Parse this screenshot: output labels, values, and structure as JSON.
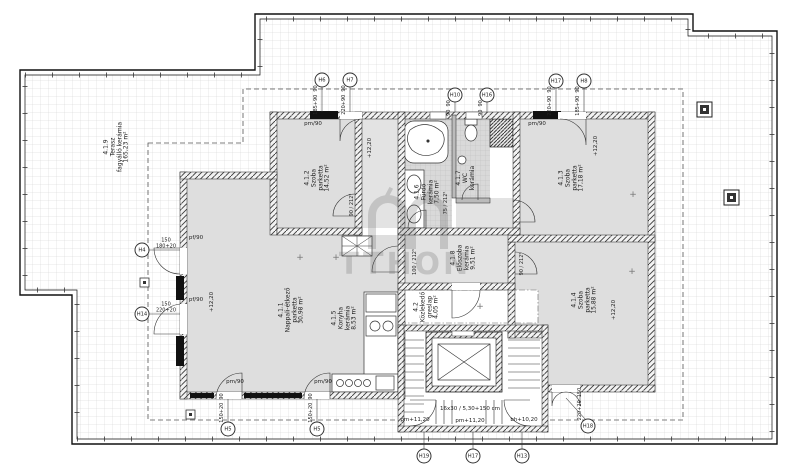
{
  "watermark": {
    "text": "TTHON"
  },
  "rooms": [
    {
      "id": "4.1.1",
      "name": "Nappali-étkező",
      "material": "parketta",
      "area": "30,98 m²"
    },
    {
      "id": "4.1.2",
      "name": "Szoba",
      "material": "parketta",
      "area": "14,52 m²"
    },
    {
      "id": "4.1.3",
      "name": "Szoba",
      "material": "parketta",
      "area": "17,18 m²"
    },
    {
      "id": "4.1.4",
      "name": "Szoba",
      "material": "parketta",
      "area": "15,88 m²"
    },
    {
      "id": "4.1.5",
      "name": "Konyha",
      "material": "kerámia",
      "area": "8,53 m²"
    },
    {
      "id": "4.1.6",
      "name": "Fürdő",
      "material": "kerámia",
      "area": "7,50 m²"
    },
    {
      "id": "4.1.7",
      "name": "WC",
      "material": "kerámia",
      "area": ""
    },
    {
      "id": "4.1.8",
      "name": "Előszoba",
      "material": "kerámia",
      "area": "9,51 m²"
    },
    {
      "id": "4.1.9",
      "name": "Terasz",
      "material": "fagyálló kerámia",
      "area": "165,23 m²"
    },
    {
      "id": "4.2",
      "name": "Közlekedő",
      "material": "greslap",
      "area": "4,05 m²"
    }
  ],
  "markers": [
    {
      "id": "H6",
      "dims": [
        "90",
        "185+90"
      ]
    },
    {
      "id": "H7",
      "dims": [
        "90",
        "220+90"
      ]
    },
    {
      "id": "H10",
      "dims": [
        "90",
        "90"
      ]
    },
    {
      "id": "H16",
      "dims": [
        "90",
        "90"
      ]
    },
    {
      "id": "H17",
      "dims": [
        "90",
        "220+90"
      ]
    },
    {
      "id": "H8",
      "dims": [
        "90",
        "185+90"
      ]
    },
    {
      "id": "H4",
      "dims": [
        "150",
        "180+20"
      ]
    },
    {
      "id": "H14",
      "dims": [
        "150",
        "220+20"
      ]
    },
    {
      "id": "H5",
      "dims": [
        "90",
        "150+20"
      ]
    },
    {
      "id": "H5",
      "dims": [
        "90",
        "150+20"
      ]
    },
    {
      "id": "H18",
      "dims": [
        "150",
        "220+20"
      ]
    },
    {
      "id": "H19",
      "dims": []
    },
    {
      "id": "H17",
      "dims": []
    },
    {
      "id": "H13",
      "dims": []
    }
  ],
  "labels": {
    "door_pm": "pm/90",
    "door_pf": "pf/90",
    "level": "+12,20",
    "stair_left": "pm+11,20",
    "stair_mid": "pm+11,20",
    "stair_right": "bh+10,20",
    "stair_note": "16x30 / 5,30+150 cm",
    "spec_90": "90 / 212⁵",
    "spec_75": "75 / 212⁵",
    "spec_100": "100 / 212⁵",
    "plus": "+"
  }
}
